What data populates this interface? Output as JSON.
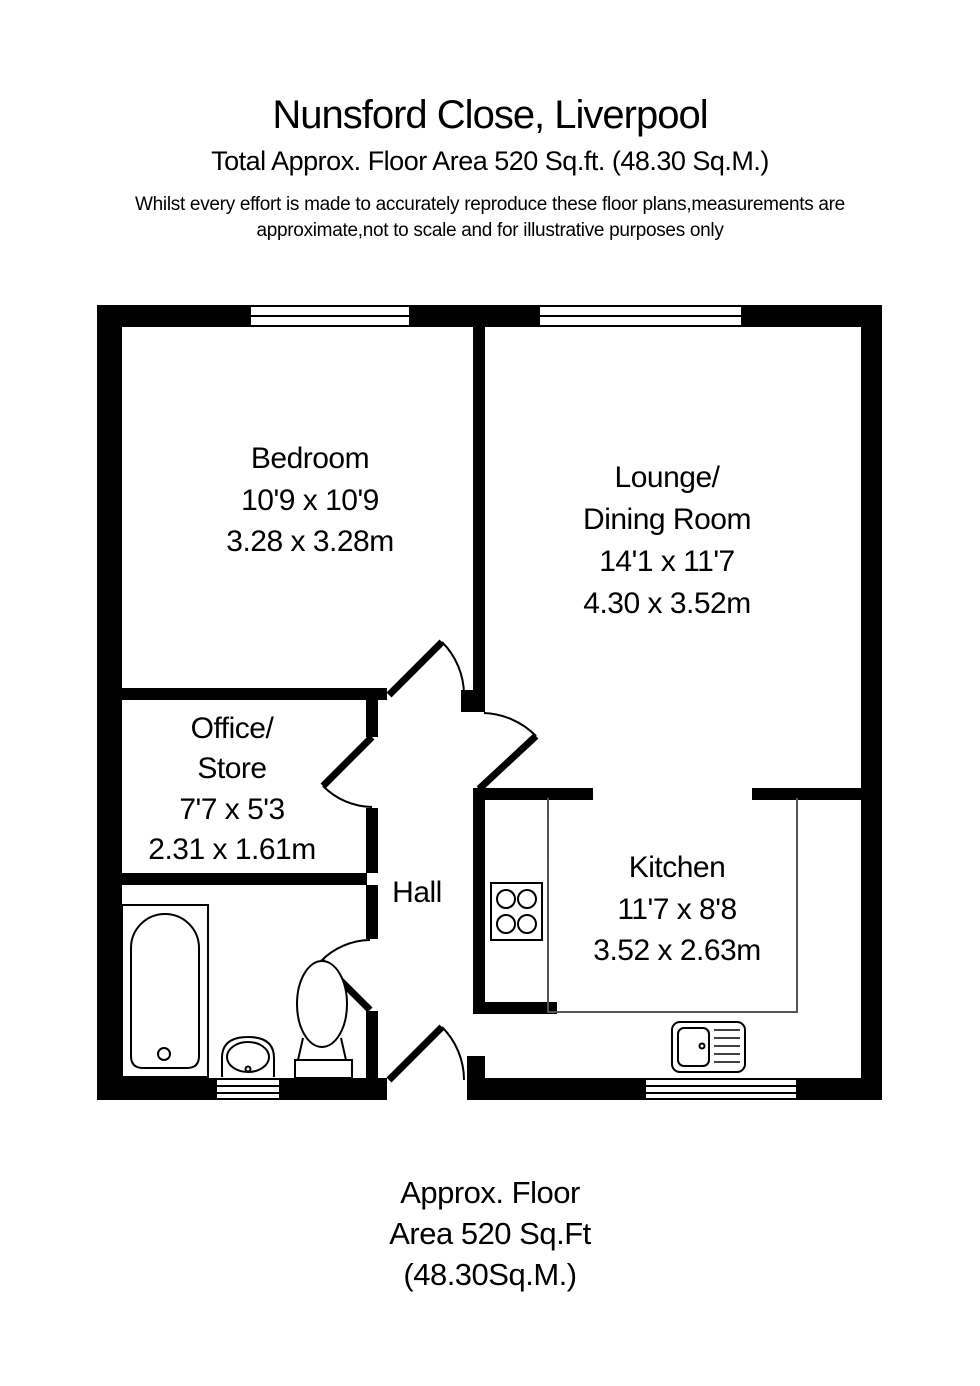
{
  "header": {
    "title": "Nunsford Close, Liverpool",
    "subtitle": "Total Approx. Floor Area 520 Sq.ft. (48.30 Sq.M.)",
    "disclaimer_line1": "Whilst every effort is made to accurately reproduce these floor plans,measurements are",
    "disclaimer_line2": "approximate,not to scale and for illustrative purposes only"
  },
  "footer": {
    "line1": "Approx. Floor",
    "line2": "Area 520 Sq.Ft",
    "line3": "(48.30Sq.M.)"
  },
  "plan": {
    "rooms": {
      "bedroom": {
        "lines": [
          "Bedroom",
          "10'9 x 10'9",
          "3.28 x 3.28m"
        ]
      },
      "lounge": {
        "lines": [
          "Lounge/",
          "Dining Room",
          "14'1 x 11'7",
          "4.30 x 3.52m"
        ]
      },
      "office": {
        "lines": [
          "Office/",
          "Store",
          "7'7 x 5'3",
          "2.31 x 1.61m"
        ]
      },
      "kitchen": {
        "lines": [
          "Kitchen",
          "11'7 x 8'8",
          "3.52 x 2.63m"
        ]
      },
      "hall": {
        "lines": [
          "Hall"
        ]
      }
    },
    "fixtures": [
      "bath",
      "basin",
      "toilet",
      "hob",
      "sink",
      "kitchen-counter"
    ],
    "windows_count": 4,
    "doors_count": 5
  },
  "colors": {
    "wall": "#000000",
    "background": "#ffffff",
    "text": "#000000"
  }
}
